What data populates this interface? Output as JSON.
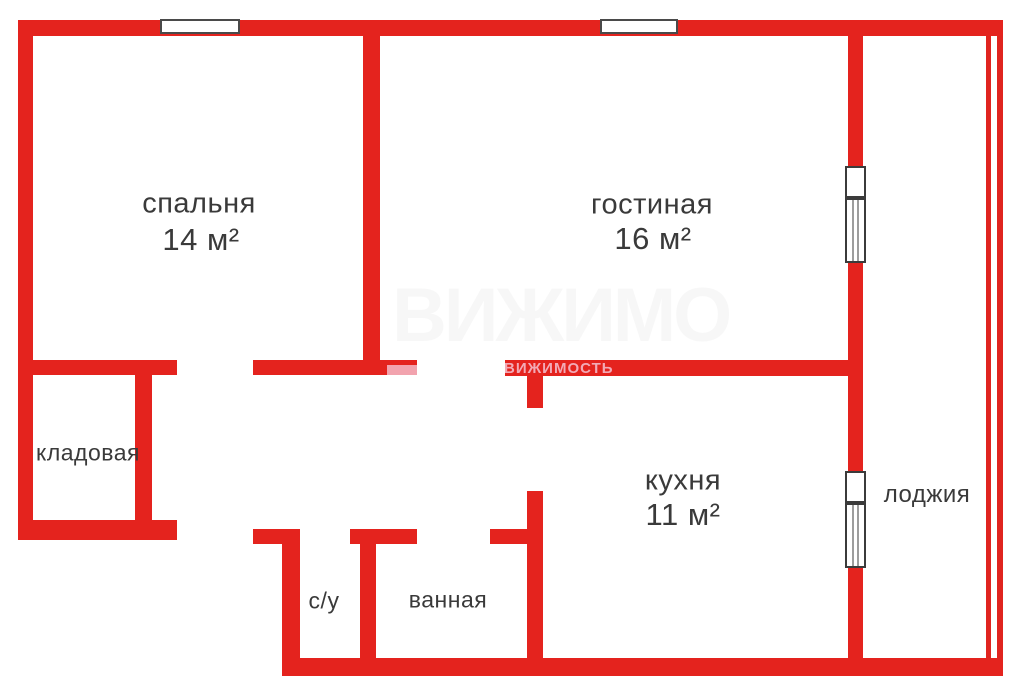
{
  "meta": {
    "type": "apartment-floor-plan",
    "language": "ru"
  },
  "colors": {
    "wall_red": "#e4231e",
    "background": "#ffffff",
    "label_text": "#3a3a3a",
    "window_border": "#4a4a4a",
    "window_glass_stripe": "#9d9d9d",
    "watermark_pink": "#f2aab6"
  },
  "rooms": [
    {
      "id": "bedroom",
      "label": "спальня",
      "area": "14 м²"
    },
    {
      "id": "living-room",
      "label": "гостиная",
      "area": "16 м²"
    },
    {
      "id": "storage",
      "label": "кладовая",
      "area": ""
    },
    {
      "id": "kitchen",
      "label": "кухня",
      "area": "11 м²"
    },
    {
      "id": "loggia",
      "label": "лоджия",
      "area": ""
    },
    {
      "id": "wc",
      "label": "с/у",
      "area": ""
    },
    {
      "id": "bathroom",
      "label": "ванная",
      "area": ""
    }
  ],
  "watermark": {
    "wall_text": "ВИЖИМОСТЬ",
    "ghost_text": "ВИЖИМОСТЬ"
  }
}
